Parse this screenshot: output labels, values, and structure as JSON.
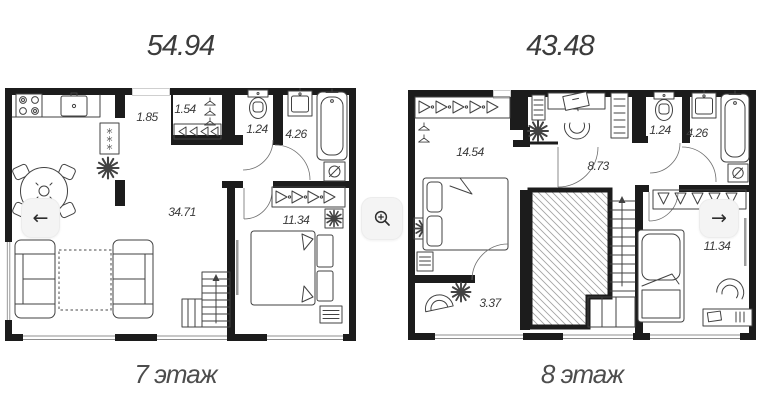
{
  "plans": [
    {
      "total_area": "54.94",
      "caption": "7 этаж",
      "rooms": [
        {
          "name": "hallway",
          "area": "1.85"
        },
        {
          "name": "wardrobe",
          "area": "1.54"
        },
        {
          "name": "wc",
          "area": "1.24"
        },
        {
          "name": "bathroom",
          "area": "4.26"
        },
        {
          "name": "living-room",
          "area": "34.71"
        },
        {
          "name": "bedroom",
          "area": "11.34"
        }
      ]
    },
    {
      "total_area": "43.48",
      "caption": "8 этаж",
      "rooms": [
        {
          "name": "bedroom-main",
          "area": "14.54"
        },
        {
          "name": "hall",
          "area": "8.73"
        },
        {
          "name": "wc",
          "area": "1.24"
        },
        {
          "name": "bathroom",
          "area": "4.26"
        },
        {
          "name": "entry",
          "area": "3.37"
        },
        {
          "name": "bedroom-second",
          "area": "11.34"
        }
      ]
    }
  ],
  "controls": {
    "prev_symbol": "←",
    "next_symbol": "→",
    "zoom_icon": "magnifier-plus-icon"
  },
  "colors": {
    "wall": "#1c1c1c",
    "furniture_line": "#424242",
    "label": "#3a3a3a",
    "caption": "#4d4d4d",
    "button_bg": "#f4f4f4"
  }
}
